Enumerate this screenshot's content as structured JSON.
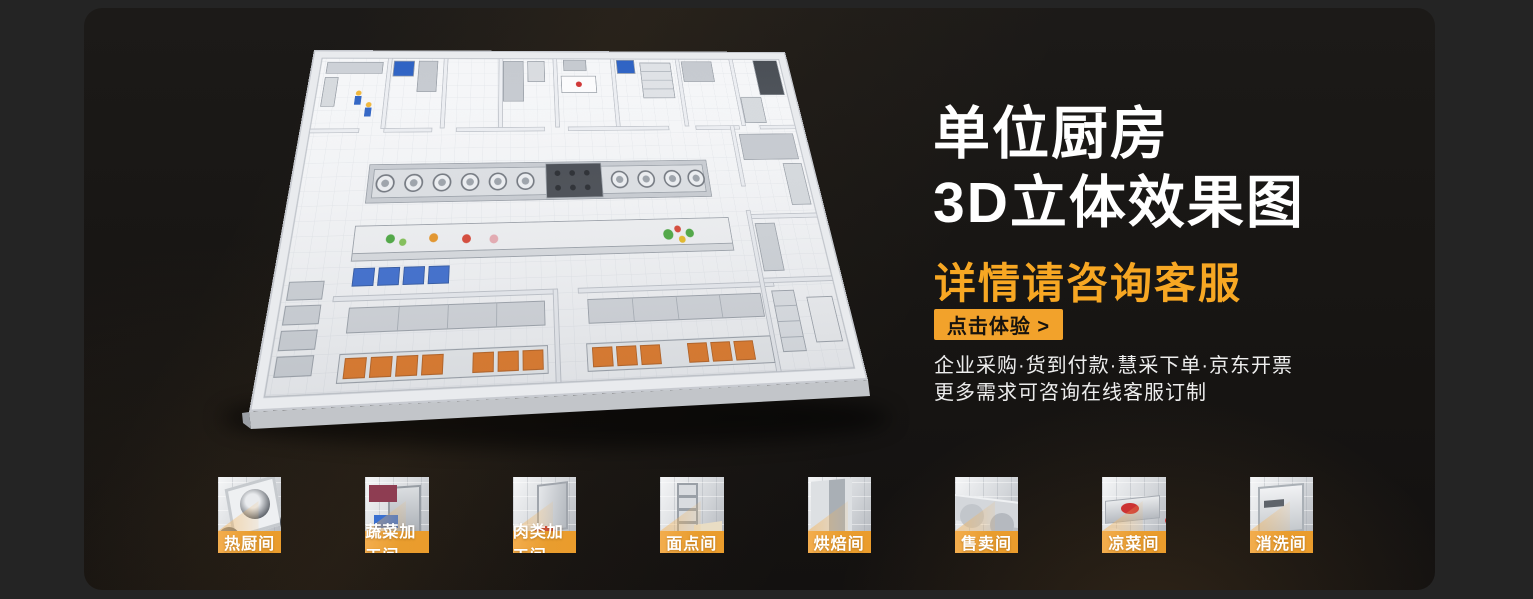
{
  "banner": {
    "title_line1": "单位厨房",
    "title_line2": "3D立体效果图",
    "subtitle": "详情请咨询客服",
    "cta_label": "点击体验 >",
    "info_lines": [
      "企业采购·货到付款·慧采下单·京东开票",
      "更多需求可咨询在线客服订制"
    ]
  },
  "thumbnails": [
    {
      "label": "热厨间"
    },
    {
      "label": "蔬菜加工间"
    },
    {
      "label": "肉类加工间"
    },
    {
      "label": "面点间"
    },
    {
      "label": "烘焙间"
    },
    {
      "label": "售卖间"
    },
    {
      "label": "凉菜间"
    },
    {
      "label": "消洗间"
    }
  ],
  "colors": {
    "accent_orange": "#F7A723",
    "cta_background": "#F2A22B",
    "label_bar": "#E99D2E",
    "banner_background": "#1A1816",
    "page_background": "#242424",
    "headline_text": "#FFFFFF",
    "info_text": "#EDEDED"
  }
}
